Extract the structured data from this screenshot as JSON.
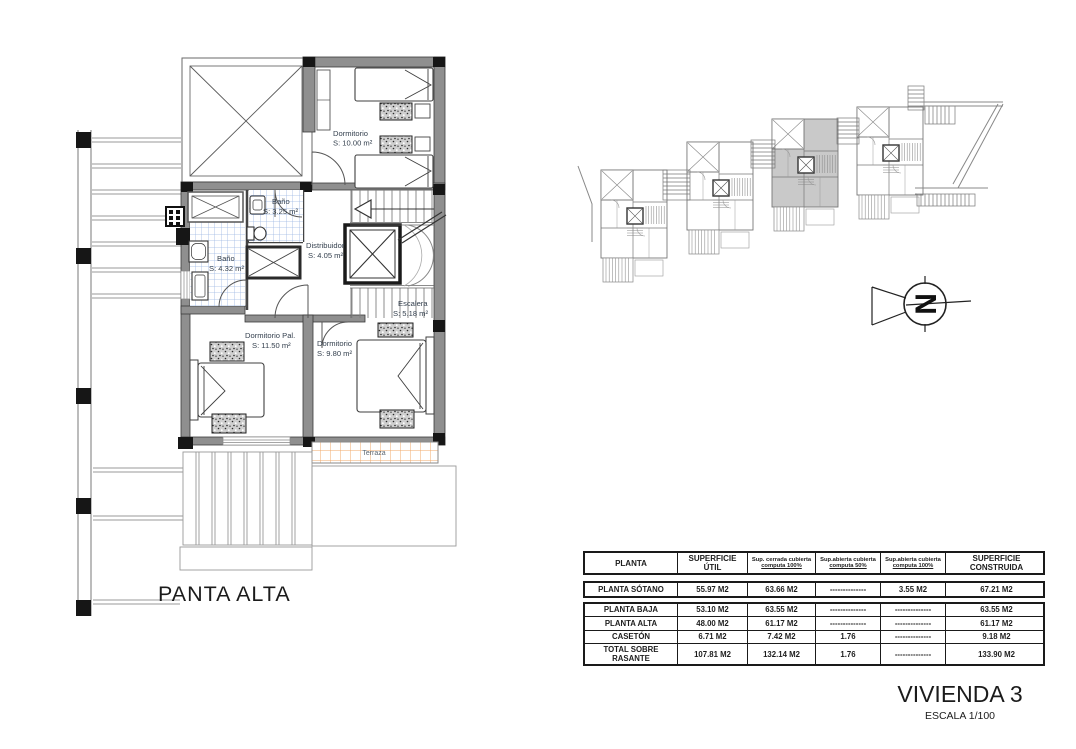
{
  "titles": {
    "plan_label": "PANTA ALTA",
    "project": "VIVIENDA 3",
    "scale": "ESCALA 1/100",
    "pool_note": "PISCINA.- Lámina de agua: 9.36 m2"
  },
  "floor_plan": {
    "rooms": [
      {
        "name": "Dormitorio",
        "area": "S: 10.00 m²"
      },
      {
        "name": "Baño",
        "area": "S: 3.25 m²"
      },
      {
        "name": "Distribuidor",
        "area": "S: 4.05 m²"
      },
      {
        "name": "Baño",
        "area": "S: 4.32 m²"
      },
      {
        "name": "Escalera",
        "area": "S: 5.18 m²"
      },
      {
        "name": "Dormitorio Pal.",
        "area": "S: 11.50 m²"
      },
      {
        "name": "Dormitorio",
        "area": "S: 9.80 m²"
      },
      {
        "name": "Terraza",
        "area": ""
      }
    ]
  },
  "site_plan": {
    "units": 4,
    "highlighted_unit": 3,
    "north_letter": "N"
  },
  "table": {
    "columns": [
      {
        "line1": "PLANTA",
        "line2": ""
      },
      {
        "line1": "SUPERFICIE ÚTIL",
        "line2": ""
      },
      {
        "line1": "Sup. cerrada cubierta",
        "line2": "computa 100%"
      },
      {
        "line1": "Sup.abierta cubierta",
        "line2": "computa 50%"
      },
      {
        "line1": "Sup.abierta cubierta",
        "line2": "computa 100%"
      },
      {
        "line1": "SUPERFICIE CONSTRUIDA",
        "line2": ""
      }
    ],
    "rows": [
      {
        "cells": [
          "PLANTA SÓTANO",
          "55.97 M2",
          "63.66 M2",
          "--------------",
          "3.55 M2",
          "67.21 M2"
        ]
      },
      {
        "cells": [
          "PLANTA BAJA",
          "53.10 M2",
          "63.55 M2",
          "--------------",
          "--------------",
          "63.55 M2"
        ]
      },
      {
        "cells": [
          "PLANTA ALTA",
          "48.00 M2",
          "61.17 M2",
          "--------------",
          "--------------",
          "61.17 M2"
        ]
      },
      {
        "cells": [
          "CASETÓN",
          "6.71 M2",
          "7.42 M2",
          "1.76",
          "--------------",
          "9.18 M2"
        ]
      },
      {
        "cells": [
          "TOTAL SOBRE RASANTE",
          "107.81 M2",
          "132.14 M2",
          "1.76",
          "--------------",
          "133.90 M2"
        ]
      }
    ]
  },
  "colors": {
    "wall_gray": "#8f8f8f",
    "tile_blue": "#9cb8e4",
    "terrace_orange": "#f0aa6a",
    "highlight_gray": "#c9c9c9",
    "label_color": "#333f4d"
  }
}
